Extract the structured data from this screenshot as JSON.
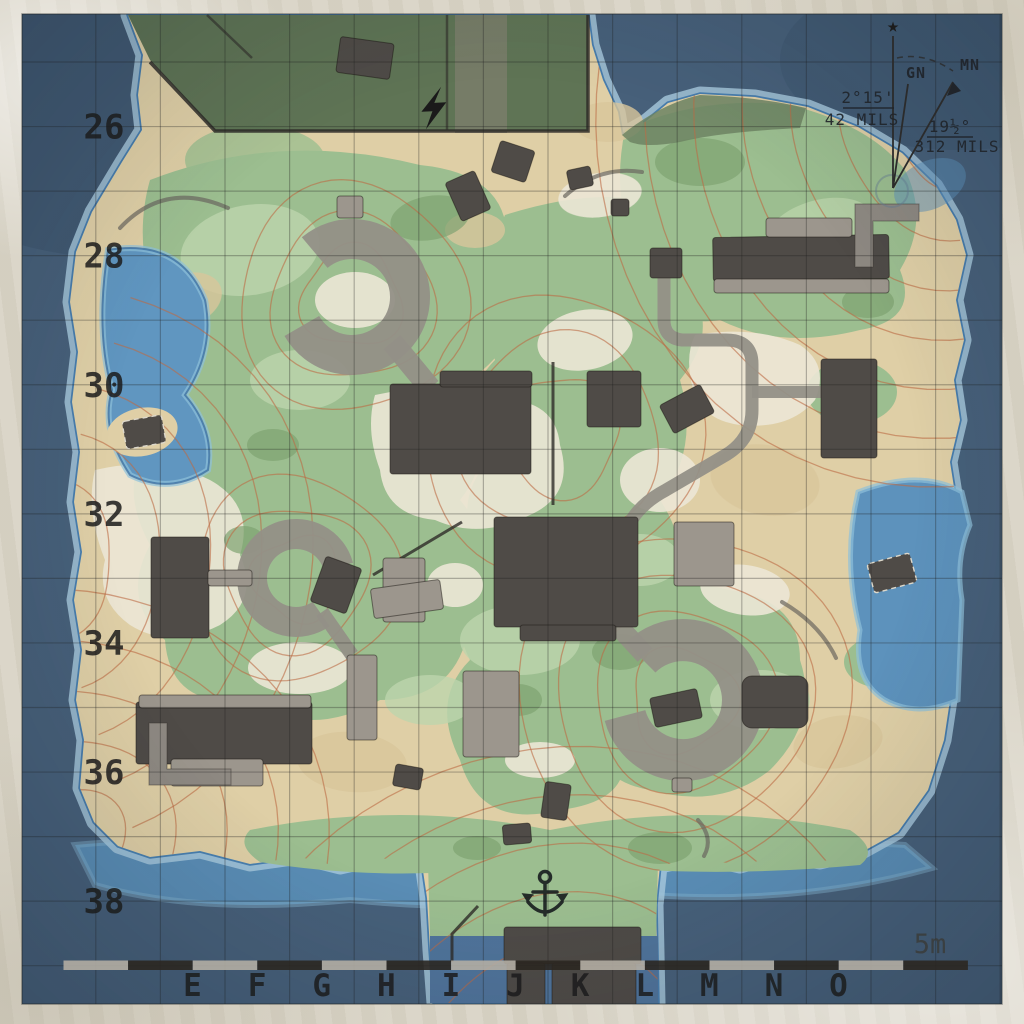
{
  "sheet": {
    "grid": {
      "row_labels": [
        "26",
        "28",
        "30",
        "32",
        "34",
        "36",
        "38"
      ],
      "column_labels": [
        "E",
        "F",
        "G",
        "H",
        "I",
        "J",
        "K",
        "L",
        "M",
        "N",
        "O"
      ]
    },
    "scale_label": "5m",
    "scale_bar": {
      "segment_count": 14,
      "segment_colors": [
        "#b3ada3",
        "#2b2721"
      ]
    },
    "declination": {
      "true_north_symbol": "★",
      "grid_north_label": "GN",
      "magnetic_north_label": "MN",
      "grid_declination_angle": "2°15'",
      "grid_declination_mils": "42 MILS",
      "magnetic_declination_angle": "19½°",
      "magnetic_declination_mils": "312 MILS"
    },
    "symbols": {
      "anchor_icon": "harbor anchor",
      "lightning_icon": "lightning bolt",
      "north_star_icon": "true north star"
    },
    "colors": {
      "paper": "#d9d4c6",
      "water_deep": "#47607a",
      "water_shallow": "#5d92bc",
      "shore_halo": "#a9cadf",
      "shore_line": "#2f6ba3",
      "sand": "#dfcfa6",
      "sand_pale": "#ece7d6",
      "green": "#9cbe90",
      "green_dark": "#5a7051",
      "contour": "#bd6a45",
      "road": "#949087",
      "building_dark": "#4f4b47",
      "building_light": "#9c968d",
      "grid_line": "#20201e",
      "ink": "#1c1c1c"
    }
  }
}
